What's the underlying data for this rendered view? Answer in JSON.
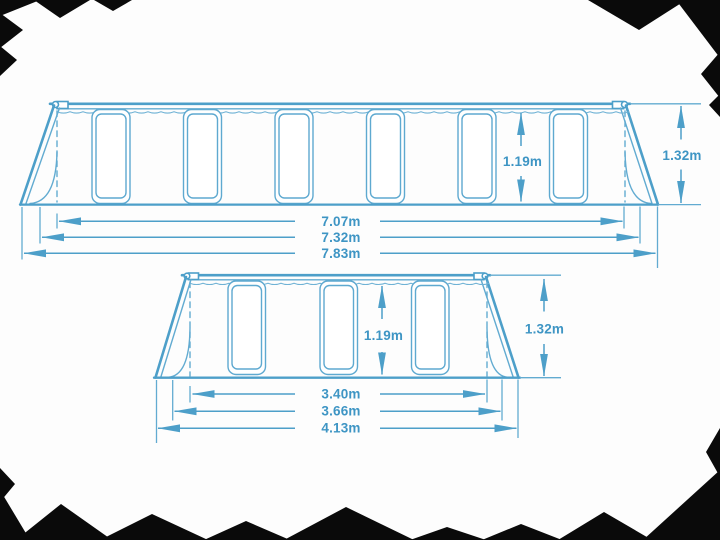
{
  "canvas": {
    "width": 720,
    "height": 540,
    "background": "#fdfdfd"
  },
  "palette": {
    "line": "#62abd1",
    "line_strong": "#4d9fc9",
    "label_text": "#3e95c4",
    "torn_edge": "#0a0a0a"
  },
  "diagram": {
    "large_pool": {
      "inner_width": "7.07m",
      "frame_width": "7.32m",
      "total_width": "7.83m",
      "wall_height": "1.19m",
      "total_height": "1.32m"
    },
    "small_pool": {
      "inner_width": "3.40m",
      "frame_width": "3.66m",
      "total_width": "4.13m",
      "wall_height": "1.19m",
      "total_height": "1.32m"
    }
  }
}
